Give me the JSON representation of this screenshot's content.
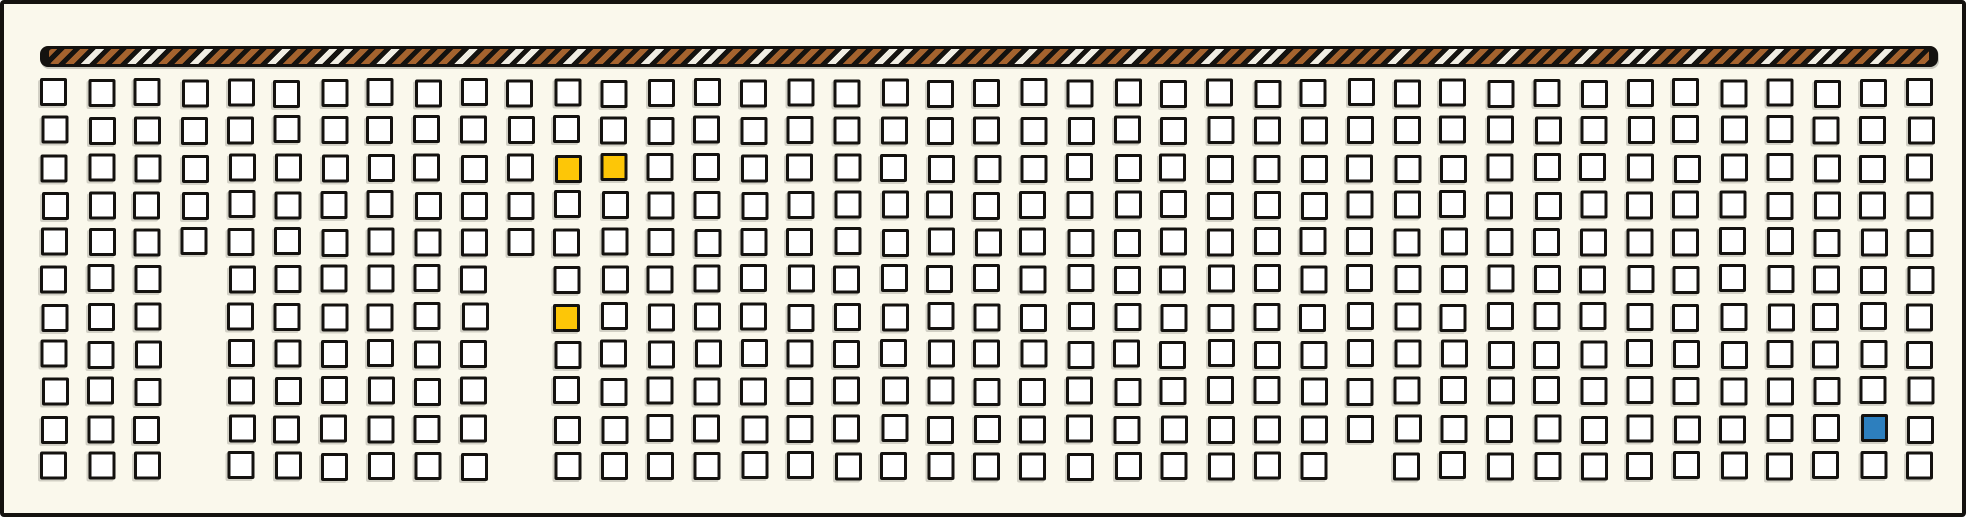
{
  "figure": {
    "description": "Hand-drawn illustration: striped rope bar above a large grid of empty checkbox-like squares; three squares filled yellow, one filled blue; a few squares missing from the grid.",
    "background_color": "#faf8ec",
    "ink_color": "#14120f",
    "rope_bar": {
      "bar_black": "#14120f",
      "stripe_brown": "#a5632e",
      "stripe_white": "#f1eee4"
    },
    "grid": {
      "rows": 11,
      "columns": 41,
      "cell_fill": "#ffffff",
      "missing_cells": [
        {
          "row": 5,
          "col": 3
        },
        {
          "row": 6,
          "col": 3
        },
        {
          "row": 7,
          "col": 3
        },
        {
          "row": 8,
          "col": 3
        },
        {
          "row": 9,
          "col": 3
        },
        {
          "row": 10,
          "col": 3
        },
        {
          "row": 5,
          "col": 10
        },
        {
          "row": 6,
          "col": 10
        },
        {
          "row": 7,
          "col": 10
        },
        {
          "row": 8,
          "col": 10
        },
        {
          "row": 9,
          "col": 10
        },
        {
          "row": 10,
          "col": 10
        },
        {
          "row": 10,
          "col": 28
        }
      ],
      "highlighted_cells": [
        {
          "row": 2,
          "col": 11,
          "color": "#fdc607",
          "name": "yellow"
        },
        {
          "row": 2,
          "col": 12,
          "color": "#fdc607",
          "name": "yellow"
        },
        {
          "row": 6,
          "col": 11,
          "color": "#fdc607",
          "name": "yellow"
        },
        {
          "row": 9,
          "col": 39,
          "color": "#2d7fbe",
          "name": "blue"
        }
      ]
    }
  }
}
